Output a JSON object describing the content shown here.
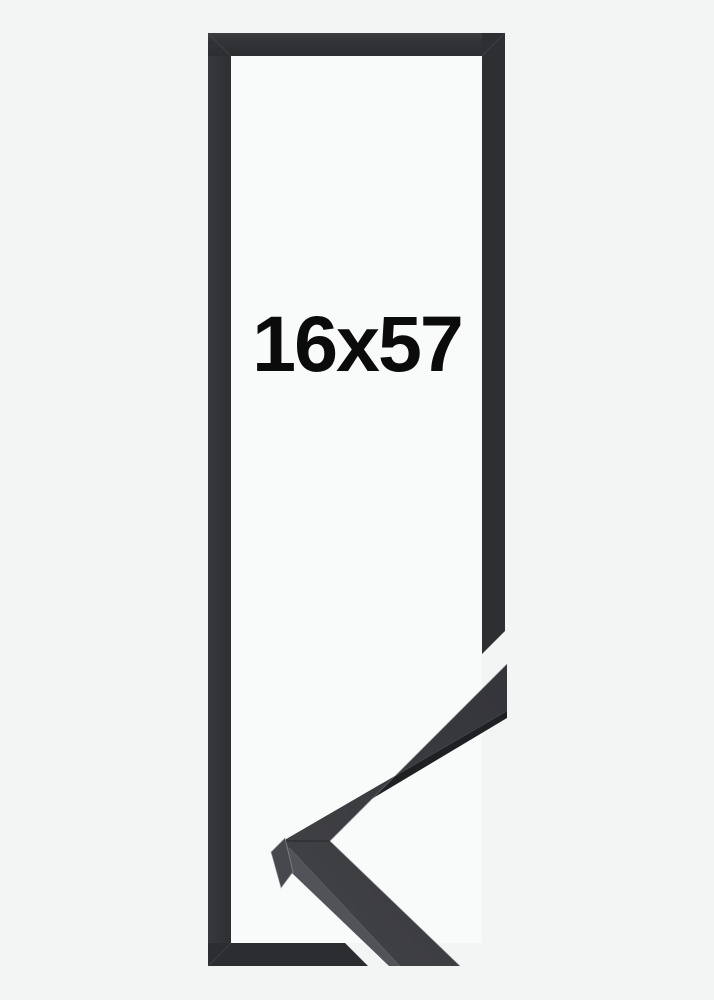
{
  "product": {
    "size_label": "16x57"
  },
  "colors": {
    "background": "#f3f4f4",
    "frame_interior": "#f9fafa",
    "frame_top": "#333437",
    "frame_left": "#313235",
    "frame_right": "#2e0f32",
    "frame_bottom": "#2c2d30",
    "moulding_face": "#3a3b3f",
    "moulding_side_dark": "#1f2024",
    "moulding_side_light": "#525358",
    "moulding_end_facet": "#47484d",
    "label": "#0b0b0b"
  }
}
